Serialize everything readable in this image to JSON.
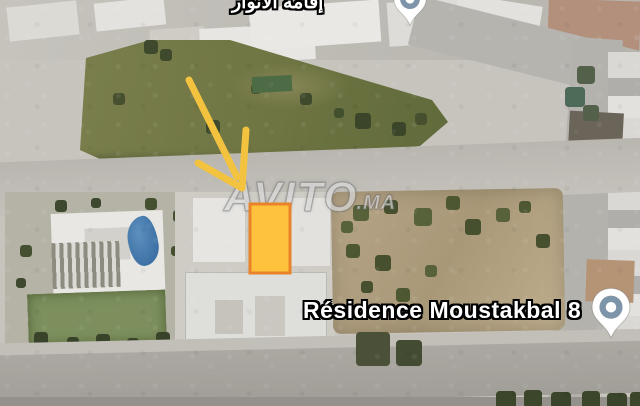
{
  "map_overlay": {
    "top_place_label": "إقامة الأنوار",
    "residence_label": "Résidence Moustakbal 8",
    "watermark": {
      "brand": "AVITO",
      "tld": ".MA"
    },
    "highlight_plot": {
      "fill": "#FFC23C",
      "border": "#E8832A"
    },
    "arrow": {
      "color": "#F3C33F"
    },
    "map_pin": {
      "ring": "#7E95A9",
      "body": "#FFFFFF"
    }
  }
}
